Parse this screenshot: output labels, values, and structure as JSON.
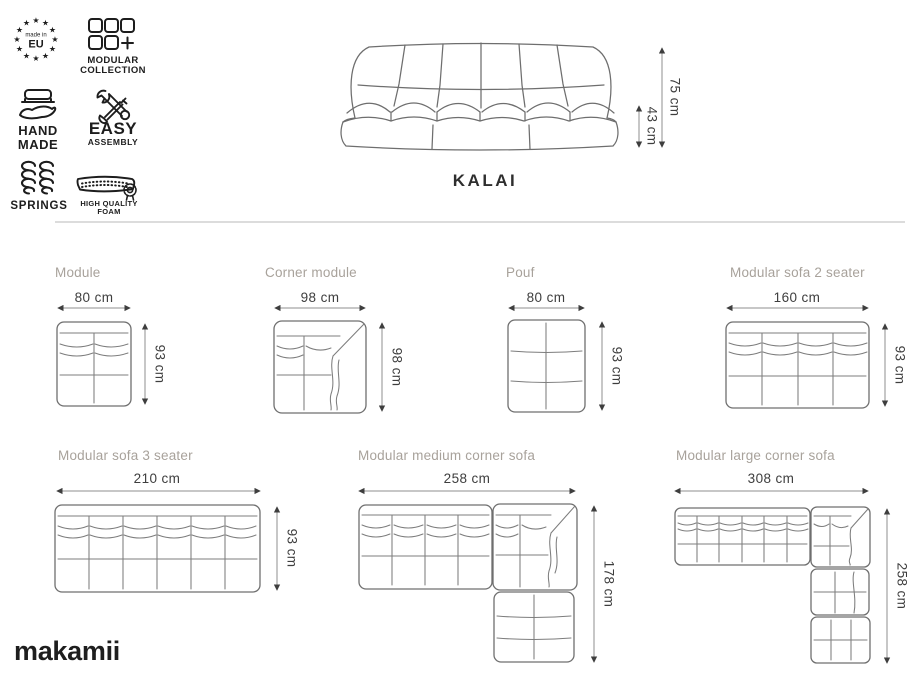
{
  "product": {
    "name": "KALAI",
    "front": {
      "total_height": "75 cm",
      "seat_height": "43 cm"
    }
  },
  "features": {
    "made_in_eu": {
      "icon": "eu-stars-badge",
      "top_label": "made in",
      "label": "EU"
    },
    "modular_collection": {
      "icon": "modular-grid-plus",
      "label_line1": "MODULAR",
      "label_line2": "COLLECTION"
    },
    "hand_made": {
      "icon": "hand-holding-sofa",
      "label_line1": "HAND",
      "label_line2": "MADE"
    },
    "easy_assembly": {
      "icon": "crossed-tools",
      "label_line1": "EASY",
      "label_line2": "ASSEMBLY"
    },
    "springs": {
      "icon": "coil-springs",
      "label": "SPRINGS"
    },
    "high_quality_foam": {
      "icon": "foam-mattress-rosette",
      "label_line1": "HIGH QUALITY",
      "label_line2": "FOAM"
    }
  },
  "diagrams": {
    "module": {
      "title": "Module",
      "width": "80 cm",
      "height": "93 cm"
    },
    "corner_module": {
      "title": "Corner module",
      "width": "98 cm",
      "height": "98 cm"
    },
    "pouf": {
      "title": "Pouf",
      "width": "80 cm",
      "height": "93 cm"
    },
    "sofa_2_seater": {
      "title": "Modular sofa 2 seater",
      "width": "160 cm",
      "height": "93 cm"
    },
    "sofa_3_seater": {
      "title": "Modular sofa 3 seater",
      "width": "210 cm",
      "height": "93 cm"
    },
    "medium_corner": {
      "title": "Modular medium corner sofa",
      "width": "258 cm",
      "height": "178 cm"
    },
    "large_corner": {
      "title": "Modular large corner sofa",
      "width": "308 cm",
      "height": "258 cm"
    }
  },
  "brand": {
    "logo": "makamii"
  },
  "colors": {
    "background": "#ffffff",
    "title_gray": "#a8a29b",
    "dimension_text": "#3e3e3e",
    "line_gray": "#7d7d7d",
    "icon_black": "#1d1d1d",
    "divider": "#dcdcdc"
  }
}
